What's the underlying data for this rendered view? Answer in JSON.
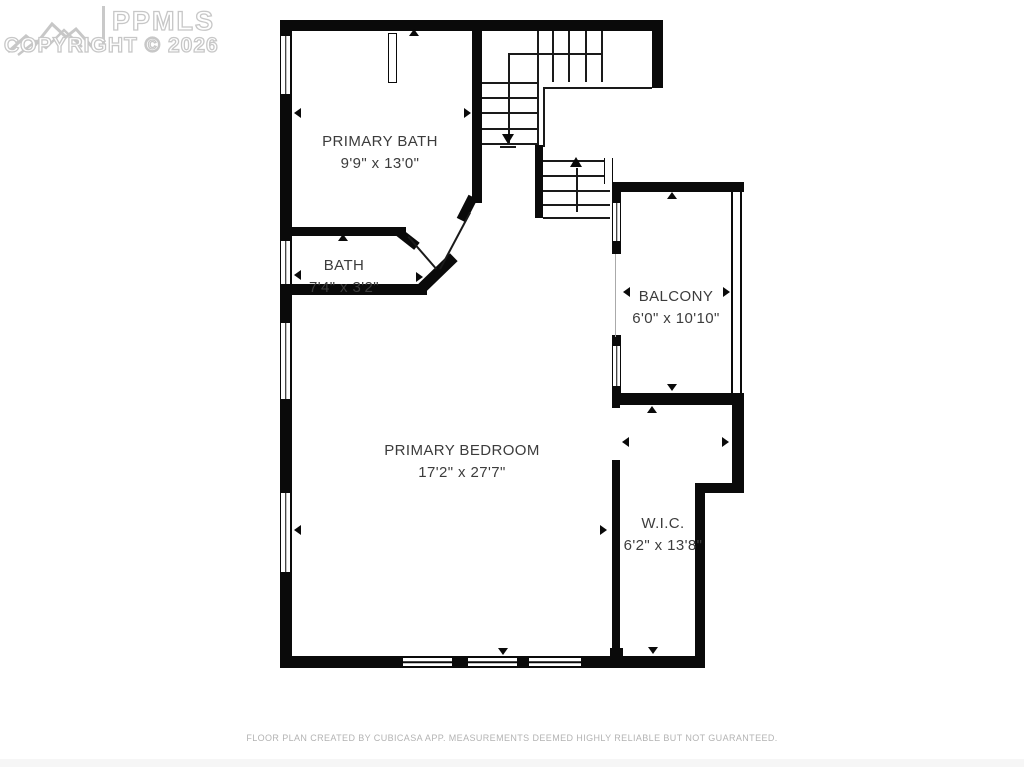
{
  "watermark": {
    "brand": "PPMLS",
    "copyright": "COPYRIGHT © 2026",
    "logo": "mountain-range-logo"
  },
  "rooms": {
    "primary_bath": {
      "name": "PRIMARY BATH",
      "dimensions": "9'9\" x 13'0\""
    },
    "bath": {
      "name": "BATH",
      "dimensions": "7'4\" x 3'2\""
    },
    "balcony": {
      "name": "BALCONY",
      "dimensions": "6'0\" x 10'10\""
    },
    "primary_bedroom": {
      "name": "PRIMARY BEDROOM",
      "dimensions": "17'2\" x 27'7\""
    },
    "wic": {
      "name": "W.I.C.",
      "dimensions": "6'2\" x 13'8\""
    }
  },
  "stairs": {
    "direction_markers": [
      "down-arrow",
      "up-arrow"
    ]
  },
  "footer": {
    "disclaimer": "FLOOR PLAN CREATED BY CUBICASA APP. MEASUREMENTS DEEMED HIGHLY RELIABLE BUT NOT GUARANTEED."
  },
  "colors": {
    "wall": "#0a0a0a",
    "background": "#ffffff",
    "label_text": "#3c3c3c",
    "watermark": "#c7c7c7",
    "footer_text": "#b3b3b3"
  }
}
